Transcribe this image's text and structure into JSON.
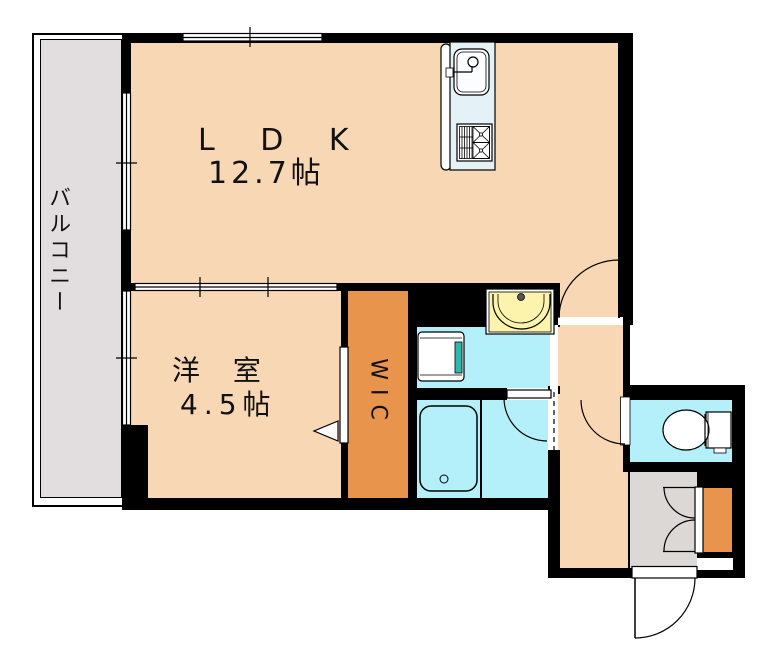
{
  "plan_title": "1LDK apartment floor plan",
  "rooms": {
    "balcony": {
      "label": "バルコニー"
    },
    "ldk": {
      "label": "L D K",
      "size": "12.7帖"
    },
    "western_room": {
      "label": "洋 室",
      "size": "4.5帖"
    },
    "wic": {
      "label": "WIC"
    },
    "washroom": {
      "label": ""
    },
    "bathroom": {
      "label": ""
    },
    "toilet": {
      "label": ""
    },
    "hallway": {
      "label": ""
    },
    "entrance": {
      "label": ""
    }
  },
  "fixtures": [
    "kitchen-sink",
    "gas-stove",
    "washbasin",
    "washing-machine-pan",
    "bathtub",
    "toilet-bowl",
    "shoe-cabinet",
    "entrance-door",
    "ldk-door",
    "bathroom-door",
    "toilet-door",
    "wic-sliding-door",
    "balcony-windows",
    "room-partition-window"
  ],
  "colors": {
    "room_peach": "#f8d7b4",
    "wic_orange": "#e9944d",
    "wet_area_cyan": "#b4f0fa",
    "counter_blue": "#e4f2f8",
    "basin_yellow": "#fcf3ad",
    "balcony_gray": "#e2dee0",
    "entrance_gray": "#dcd8d5",
    "washer_teal": "#2fb8ac",
    "wall_black": "#000000"
  }
}
